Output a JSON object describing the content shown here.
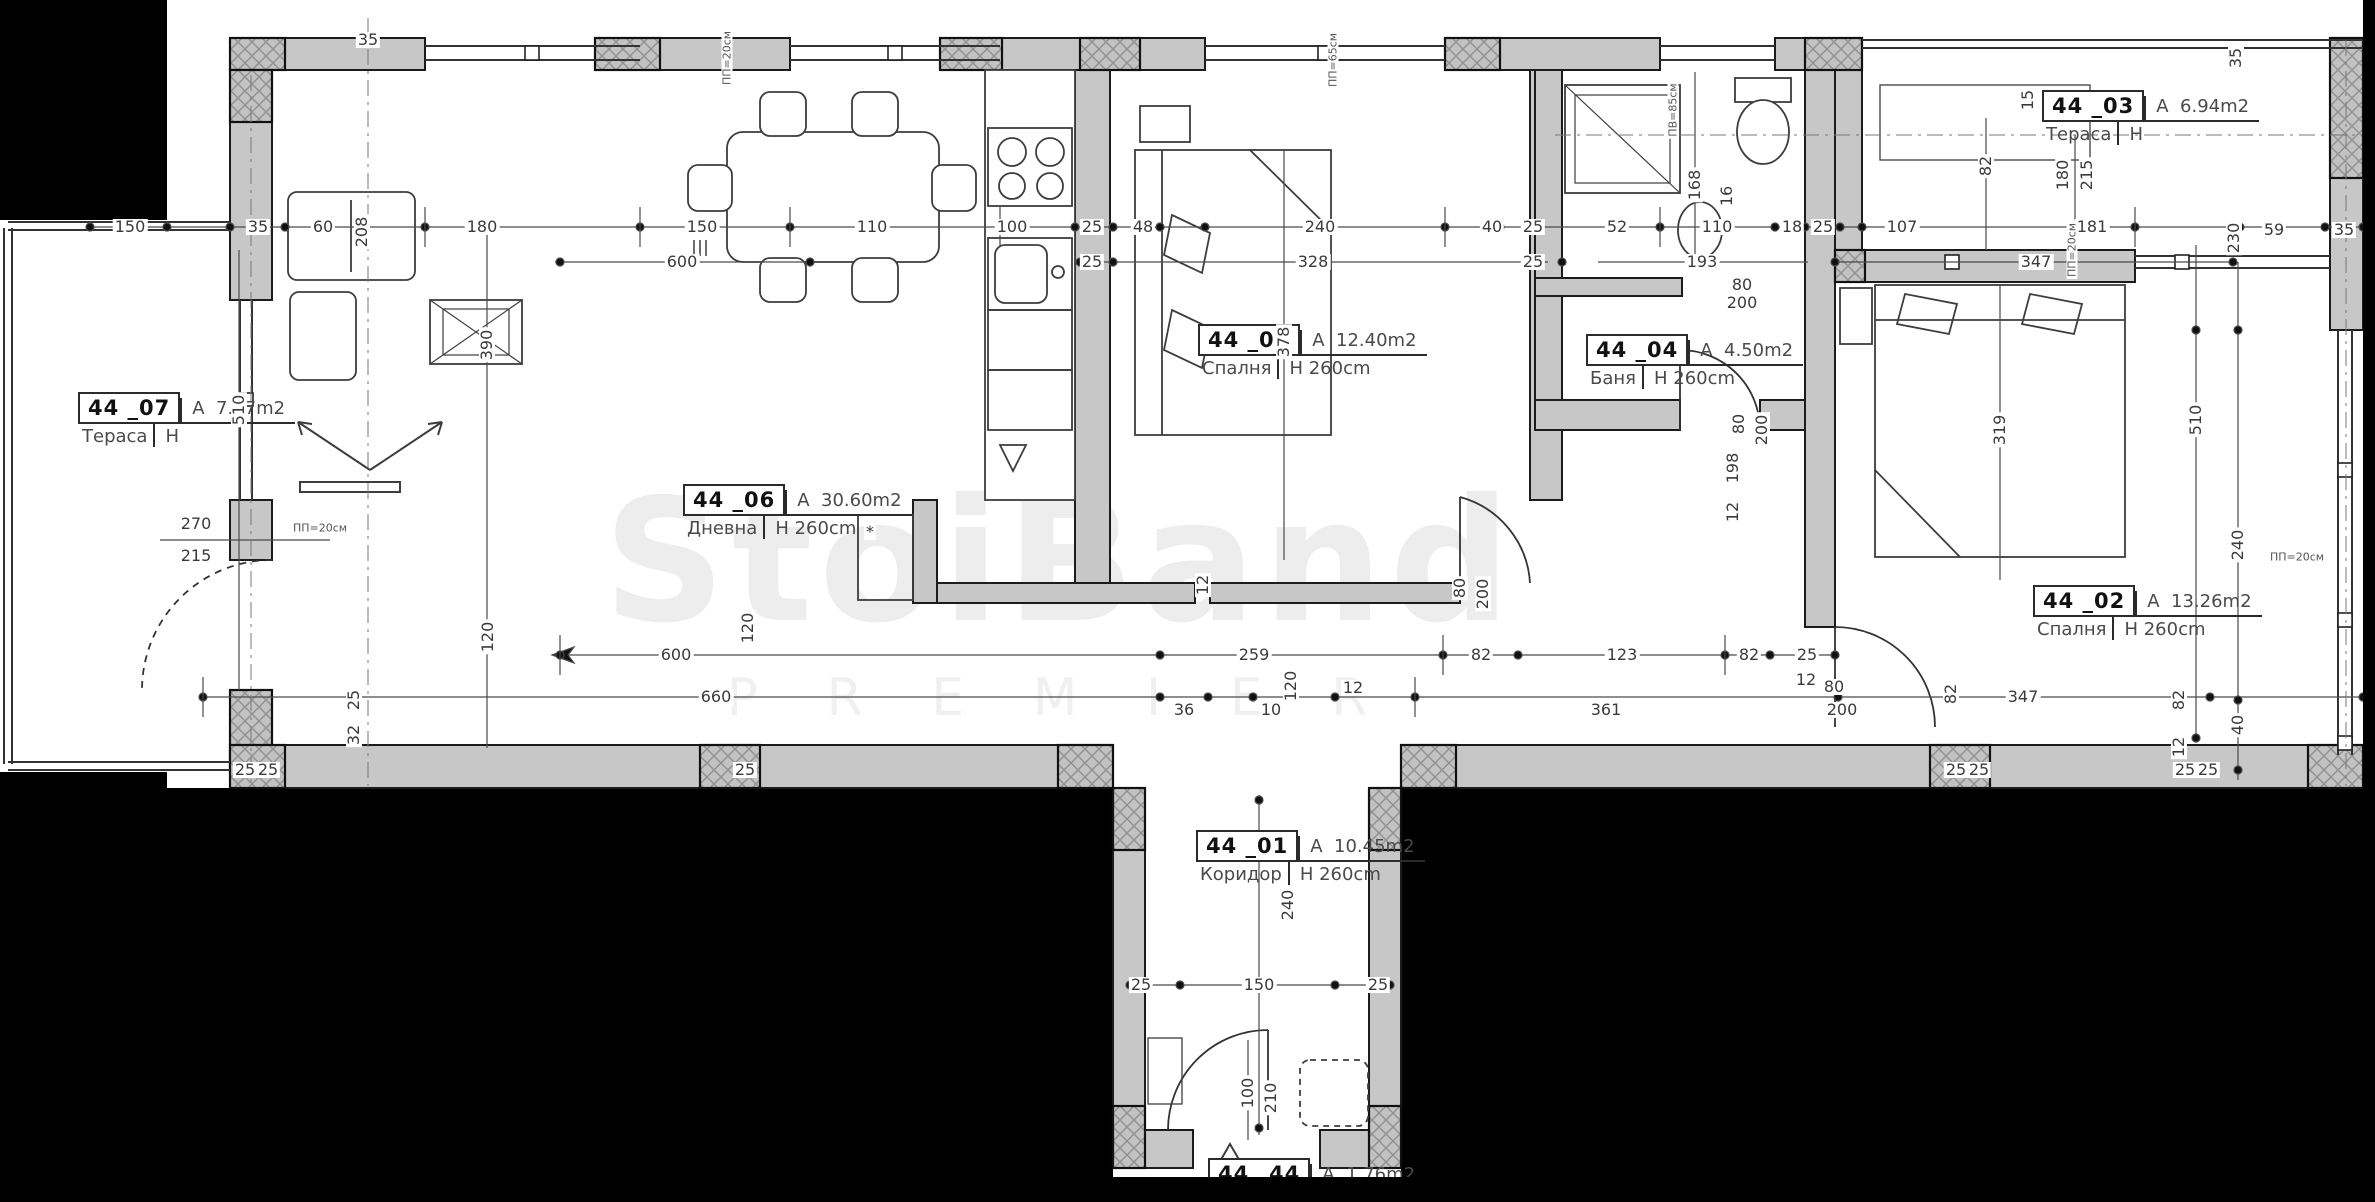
{
  "meta": {
    "drawing_type": "apartment floor plan",
    "unit_number": "44"
  },
  "labels": {
    "area_prefix": "A",
    "height_prefix": "H"
  },
  "colors": {
    "paper": "#ffffff",
    "wall": "#c7c7c7",
    "line": "#1c1c1c",
    "dim_text": "#3a3a3a",
    "background": "#000000"
  },
  "watermark": {
    "line1": "StoiBand",
    "line2": "P R E M I E R"
  },
  "rooms": [
    {
      "code": "44",
      "num": "_07",
      "name": "Тераса",
      "area": "7.97m2",
      "h": "",
      "x": 78,
      "y": 392
    },
    {
      "code": "44",
      "num": "_06",
      "name": "Дневна",
      "area": "30.60m2",
      "h": "260cm",
      "x": 683,
      "y": 484
    },
    {
      "code": "44",
      "num": "_05",
      "name": "Спалня",
      "area": "12.40m2",
      "h": "260cm",
      "x": 1198,
      "y": 324
    },
    {
      "code": "44",
      "num": "_04",
      "name": "Баня",
      "area": "4.50m2",
      "h": "260cm",
      "x": 1586,
      "y": 334
    },
    {
      "code": "44",
      "num": "_03",
      "name": "Тераса",
      "area": "6.94m2",
      "h": "",
      "x": 2042,
      "y": 90
    },
    {
      "code": "44",
      "num": "_02",
      "name": "Спалня",
      "area": "13.26m2",
      "h": "260cm",
      "x": 2033,
      "y": 585
    },
    {
      "code": "44",
      "num": "_01",
      "name": "Коридор",
      "area": "10.45m2",
      "h": "260cm",
      "x": 1196,
      "y": 830
    },
    {
      "code": "44",
      "num": "_44",
      "name": "",
      "area": "1.76m2",
      "h": "",
      "x": 1208,
      "y": 1158
    }
  ],
  "dimensions": [
    {
      "t": "150",
      "x": 130,
      "y": 227
    },
    {
      "t": "35",
      "x": 258,
      "y": 227
    },
    {
      "t": "60",
      "x": 323,
      "y": 227
    },
    {
      "t": "208",
      "x": 362,
      "y": 232,
      "v": true
    },
    {
      "t": "180",
      "x": 482,
      "y": 227
    },
    {
      "t": "150",
      "x": 702,
      "y": 227
    },
    {
      "t": "110",
      "x": 872,
      "y": 227
    },
    {
      "t": "100",
      "x": 1012,
      "y": 227
    },
    {
      "t": "25",
      "x": 1092,
      "y": 227
    },
    {
      "t": "48",
      "x": 1143,
      "y": 227
    },
    {
      "t": "240",
      "x": 1320,
      "y": 227
    },
    {
      "t": "40",
      "x": 1492,
      "y": 227
    },
    {
      "t": "25",
      "x": 1533,
      "y": 227
    },
    {
      "t": "52",
      "x": 1617,
      "y": 227
    },
    {
      "t": "110",
      "x": 1717,
      "y": 227
    },
    {
      "t": "16",
      "x": 1727,
      "y": 196,
      "v": true
    },
    {
      "t": "18",
      "x": 1792,
      "y": 227
    },
    {
      "t": "25",
      "x": 1823,
      "y": 227
    },
    {
      "t": "107",
      "x": 1902,
      "y": 227
    },
    {
      "t": "181",
      "x": 2092,
      "y": 227
    },
    {
      "t": "230",
      "x": 2234,
      "y": 238,
      "v": true
    },
    {
      "t": "59",
      "x": 2274,
      "y": 230
    },
    {
      "t": "35",
      "x": 2344,
      "y": 230
    },
    {
      "t": "600",
      "x": 682,
      "y": 262
    },
    {
      "t": "25",
      "x": 1092,
      "y": 262
    },
    {
      "t": "328",
      "x": 1313,
      "y": 262
    },
    {
      "t": "25",
      "x": 1533,
      "y": 262
    },
    {
      "t": "193",
      "x": 1702,
      "y": 262
    },
    {
      "t": "347",
      "x": 2036,
      "y": 262
    },
    {
      "t": "ПП=20см",
      "x": 2072,
      "y": 250,
      "v": true,
      "s": true
    },
    {
      "t": "35",
      "x": 368,
      "y": 40
    },
    {
      "t": "ПП=20см",
      "x": 727,
      "y": 58,
      "v": true,
      "s": true
    },
    {
      "t": "ПП=65см",
      "x": 1333,
      "y": 60,
      "v": true,
      "s": true
    },
    {
      "t": "ПВ=85см",
      "x": 1673,
      "y": 110,
      "v": true,
      "s": true
    },
    {
      "t": "168",
      "x": 1695,
      "y": 185,
      "v": true
    },
    {
      "t": "15",
      "x": 2028,
      "y": 100,
      "v": true
    },
    {
      "t": "82",
      "x": 1986,
      "y": 166,
      "v": true
    },
    {
      "t": "180",
      "x": 2063,
      "y": 175,
      "v": true
    },
    {
      "t": "215",
      "x": 2087,
      "y": 175,
      "v": true
    },
    {
      "t": "35",
      "x": 2236,
      "y": 58,
      "v": true
    },
    {
      "t": "270",
      "x": 196,
      "y": 524
    },
    {
      "t": "215",
      "x": 196,
      "y": 556
    },
    {
      "t": "ПП=20см",
      "x": 320,
      "y": 528,
      "s": true
    },
    {
      "t": "510",
      "x": 239,
      "y": 410,
      "v": true
    },
    {
      "t": "390",
      "x": 487,
      "y": 345,
      "v": true
    },
    {
      "t": "120",
      "x": 488,
      "y": 637,
      "v": true
    },
    {
      "t": "25",
      "x": 354,
      "y": 700,
      "v": true
    },
    {
      "t": "32",
      "x": 354,
      "y": 735,
      "v": true
    },
    {
      "t": "25",
      "x": 245,
      "y": 770
    },
    {
      "t": "25",
      "x": 268,
      "y": 770
    },
    {
      "t": "25",
      "x": 745,
      "y": 770
    },
    {
      "t": "600",
      "x": 676,
      "y": 655
    },
    {
      "t": "120",
      "x": 748,
      "y": 628,
      "v": true
    },
    {
      "t": "259",
      "x": 1254,
      "y": 655
    },
    {
      "t": "82",
      "x": 1481,
      "y": 655
    },
    {
      "t": "123",
      "x": 1622,
      "y": 655
    },
    {
      "t": "82",
      "x": 1749,
      "y": 655
    },
    {
      "t": "25",
      "x": 1807,
      "y": 655
    },
    {
      "t": "660",
      "x": 716,
      "y": 697
    },
    {
      "t": "36",
      "x": 1184,
      "y": 710
    },
    {
      "t": "10",
      "x": 1271,
      "y": 710
    },
    {
      "t": "120",
      "x": 1291,
      "y": 686,
      "v": true
    },
    {
      "t": "12",
      "x": 1353,
      "y": 688
    },
    {
      "t": "361",
      "x": 1606,
      "y": 710
    },
    {
      "t": "12",
      "x": 1806,
      "y": 680
    },
    {
      "t": "80",
      "x": 1834,
      "y": 687
    },
    {
      "t": "200",
      "x": 1842,
      "y": 710
    },
    {
      "t": "82",
      "x": 1951,
      "y": 694,
      "v": true
    },
    {
      "t": "347",
      "x": 2023,
      "y": 697
    },
    {
      "t": "12",
      "x": 1203,
      "y": 585,
      "v": true
    },
    {
      "t": "378",
      "x": 1284,
      "y": 342,
      "v": true
    },
    {
      "t": "80",
      "x": 1460,
      "y": 588,
      "v": true
    },
    {
      "t": "200",
      "x": 1483,
      "y": 594,
      "v": true
    },
    {
      "t": "80",
      "x": 1742,
      "y": 285
    },
    {
      "t": "200",
      "x": 1742,
      "y": 303
    },
    {
      "t": "80",
      "x": 1739,
      "y": 424,
      "v": true
    },
    {
      "t": "200",
      "x": 1762,
      "y": 430,
      "v": true
    },
    {
      "t": "198",
      "x": 1733,
      "y": 468,
      "v": true
    },
    {
      "t": "12",
      "x": 1733,
      "y": 512,
      "v": true
    },
    {
      "t": "319",
      "x": 2000,
      "y": 430,
      "v": true
    },
    {
      "t": "510",
      "x": 2196,
      "y": 420,
      "v": true
    },
    {
      "t": "240",
      "x": 2238,
      "y": 545,
      "v": true
    },
    {
      "t": "ПП=20см",
      "x": 2297,
      "y": 557,
      "s": true
    },
    {
      "t": "40",
      "x": 2238,
      "y": 725,
      "v": true
    },
    {
      "t": "82",
      "x": 2179,
      "y": 700,
      "v": true
    },
    {
      "t": "12",
      "x": 2179,
      "y": 747,
      "v": true
    },
    {
      "t": "25",
      "x": 2185,
      "y": 770
    },
    {
      "t": "25",
      "x": 2208,
      "y": 770
    },
    {
      "t": "25",
      "x": 1956,
      "y": 770
    },
    {
      "t": "25",
      "x": 1979,
      "y": 770
    },
    {
      "t": "240",
      "x": 1288,
      "y": 905,
      "v": true
    },
    {
      "t": "150",
      "x": 1259,
      "y": 985
    },
    {
      "t": "25",
      "x": 1141,
      "y": 985
    },
    {
      "t": "25",
      "x": 1378,
      "y": 985
    },
    {
      "t": "100",
      "x": 1248,
      "y": 1093,
      "v": true
    },
    {
      "t": "210",
      "x": 1271,
      "y": 1098,
      "v": true
    },
    {
      "t": "*",
      "x": 870,
      "y": 532
    }
  ]
}
